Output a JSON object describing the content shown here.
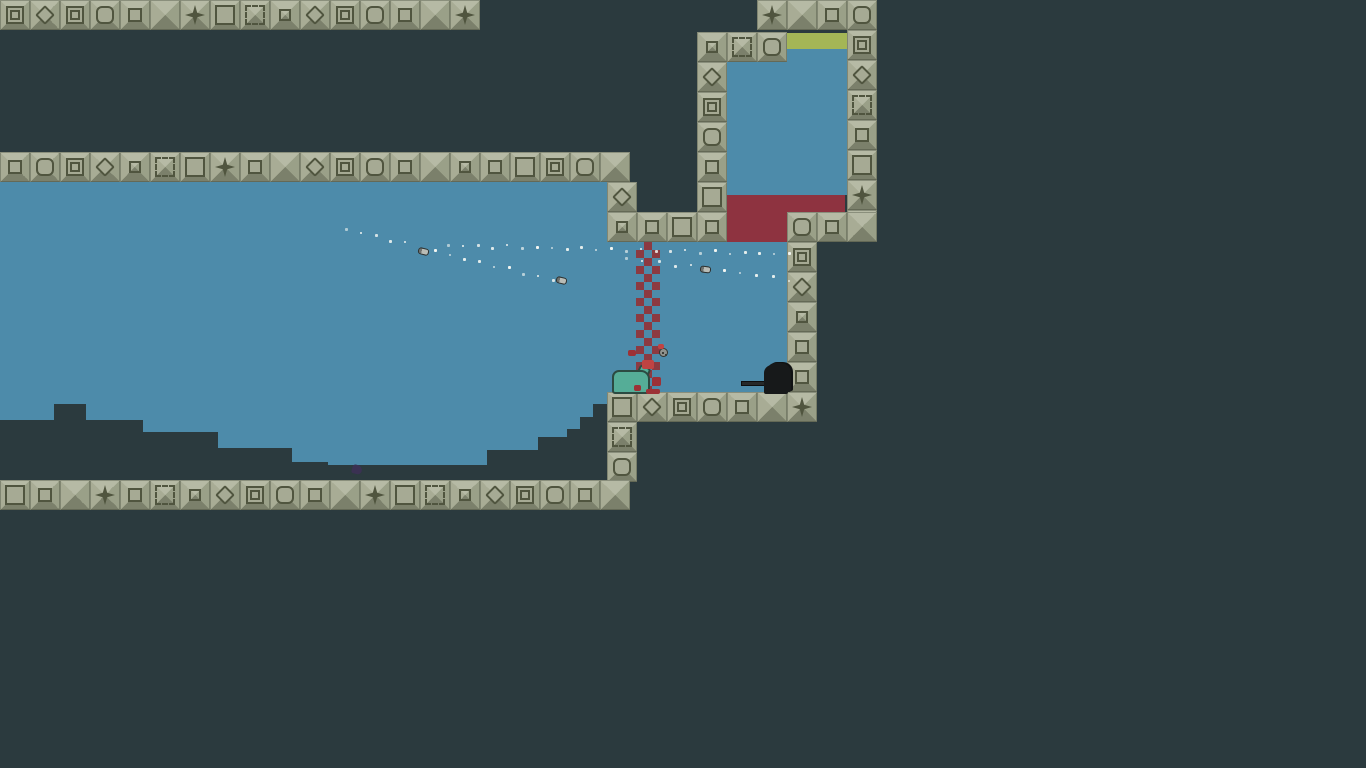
{
  "scene": {
    "width": 1366,
    "height": 768,
    "description": "pixel platformer arena"
  },
  "colors": {
    "background": "#2b3a3e",
    "water": "#4d8baa",
    "red_zone": "#8e3340",
    "green_strip": "#a4b656",
    "checker_red": "#8c3a41",
    "tile_top": "#b6baa5",
    "tile_left": "#a8ac95",
    "tile_right": "#9aa088",
    "tile_bottom": "#7b806b",
    "tile_face": "#a6aa94",
    "tile_line": "#50553f",
    "terrain": "#2b3a3e",
    "trail_dot": "#f3f6f2",
    "blood": "#9c3136",
    "name_text": "#f2f2ef"
  },
  "icons": {
    "heart": "♥"
  },
  "players": [
    {
      "id": "shinoa",
      "name": "Shinoa",
      "x": 255,
      "y": 176
    },
    {
      "id": "broso56",
      "name": "Broso56",
      "x": 612,
      "y": 342
    }
  ],
  "regions": [
    {
      "name": "main-room-water",
      "x": 0,
      "y": 182,
      "w": 610,
      "h": 298,
      "color": "water"
    },
    {
      "name": "passage-water",
      "x": 607,
      "y": 242,
      "w": 180,
      "h": 150,
      "color": "water"
    },
    {
      "name": "upper-room-water",
      "x": 727,
      "y": 48,
      "w": 120,
      "h": 147,
      "color": "water"
    },
    {
      "name": "upper-room-green-strip",
      "x": 787,
      "y": 33,
      "w": 60,
      "h": 16,
      "color": "green_strip"
    },
    {
      "name": "red-zone",
      "x": 727,
      "y": 195,
      "w": 118,
      "h": 47,
      "color": "red_zone"
    }
  ],
  "terrain_steps": [
    {
      "x": 0,
      "y": 420,
      "w": 54
    },
    {
      "x": 54,
      "y": 404,
      "w": 32
    },
    {
      "x": 86,
      "y": 420,
      "w": 57
    },
    {
      "x": 143,
      "y": 432,
      "w": 75
    },
    {
      "x": 218,
      "y": 448,
      "w": 74
    },
    {
      "x": 292,
      "y": 462,
      "w": 36
    },
    {
      "x": 328,
      "y": 465,
      "w": 159
    },
    {
      "x": 487,
      "y": 450,
      "w": 51
    },
    {
      "x": 538,
      "y": 437,
      "w": 29
    },
    {
      "x": 567,
      "y": 429,
      "w": 13
    },
    {
      "x": 580,
      "y": 417,
      "w": 13
    },
    {
      "x": 593,
      "y": 404,
      "w": 14
    }
  ],
  "tile_strips": [
    {
      "name": "ceiling-row",
      "x": 0,
      "y": 0,
      "dir": "h",
      "motifs": [
        "inset",
        "diamond",
        "inset",
        "rounded",
        "square",
        "pyramid",
        "star",
        "osquare",
        "blarge",
        "bsmall",
        "diamond",
        "inset",
        "rounded",
        "square",
        "pyramid",
        "star"
      ]
    },
    {
      "name": "top-right-row",
      "x": 757,
      "y": 0,
      "dir": "h",
      "motifs": [
        "star",
        "pyramid",
        "square",
        "rounded"
      ]
    },
    {
      "name": "upper-room-top-row",
      "x": 727,
      "y": 32,
      "dir": "h",
      "motifs": [
        "blarge",
        "rounded"
      ]
    },
    {
      "name": "upper-room-left-wall",
      "x": 697,
      "y": 32,
      "dir": "v",
      "motifs": [
        "bsmall",
        "diamond",
        "inset",
        "rounded",
        "square",
        "osquare"
      ]
    },
    {
      "name": "upper-room-right-wall",
      "x": 847,
      "y": 30,
      "dir": "v",
      "motifs": [
        "inset",
        "diamond",
        "blarge",
        "square",
        "osquare",
        "star",
        "pyramid"
      ]
    },
    {
      "name": "mid-row",
      "x": 0,
      "y": 152,
      "dir": "h",
      "motifs": [
        "square",
        "rounded",
        "inset",
        "diamond",
        "bsmall",
        "blarge",
        "osquare",
        "star",
        "square",
        "pyramid",
        "diamond",
        "inset",
        "rounded",
        "square",
        "pyramid",
        "bsmall",
        "square",
        "osquare",
        "inset",
        "rounded",
        "pyramid"
      ]
    },
    {
      "name": "main-right-col",
      "x": 607,
      "y": 182,
      "dir": "v",
      "motifs": [
        "diamond"
      ]
    },
    {
      "name": "passage-top-row",
      "x": 607,
      "y": 212,
      "dir": "h",
      "motifs": [
        "bsmall",
        "square",
        "osquare",
        "square"
      ]
    },
    {
      "name": "red-floor-row",
      "x": 787,
      "y": 212,
      "dir": "h",
      "motifs": [
        "rounded",
        "square",
        "pyramid"
      ]
    },
    {
      "name": "subroom-right-wall",
      "x": 787,
      "y": 242,
      "dir": "v",
      "motifs": [
        "inset",
        "diamond",
        "bsmall",
        "square",
        "square",
        "pyramid"
      ]
    },
    {
      "name": "subroom-floor-row",
      "x": 607,
      "y": 392,
      "dir": "h",
      "motifs": [
        "osquare",
        "diamond",
        "inset",
        "rounded",
        "square",
        "pyramid",
        "star"
      ]
    },
    {
      "name": "lower-col",
      "x": 607,
      "y": 422,
      "dir": "v",
      "motifs": [
        "blarge",
        "rounded"
      ]
    },
    {
      "name": "bottom-row",
      "x": 0,
      "y": 480,
      "dir": "h",
      "motifs": [
        "osquare",
        "square",
        "pyramid",
        "star",
        "square",
        "blarge",
        "bsmall",
        "diamond",
        "inset",
        "rounded",
        "square",
        "pyramid",
        "star",
        "osquare",
        "blarge",
        "bsmall",
        "diamond",
        "inset",
        "rounded",
        "square",
        "pyramid"
      ]
    }
  ],
  "checker": {
    "name": "checker-curtain",
    "x": 636,
    "y": 242,
    "w": 24,
    "h": 150,
    "cell": 8
  },
  "trails": [
    {
      "name": "steep-trail",
      "x1": 345,
      "y1": 228,
      "x2": 552,
      "y2": 279,
      "dots": 15
    },
    {
      "name": "shallow-trail",
      "x1": 447,
      "y1": 244,
      "x2": 788,
      "y2": 253,
      "dots": 24
    },
    {
      "name": "low-trail",
      "x1": 625,
      "y1": 257,
      "x2": 788,
      "y2": 278,
      "dots": 11
    }
  ],
  "bullets": [
    {
      "x": 418,
      "y": 248,
      "rot": 14
    },
    {
      "x": 556,
      "y": 277,
      "rot": 14
    },
    {
      "x": 700,
      "y": 266,
      "rot": 7
    }
  ],
  "props": [
    {
      "type": "grenade",
      "x": 659,
      "y": 348
    },
    {
      "type": "corpse",
      "x": 612,
      "y": 366
    },
    {
      "type": "crow",
      "x": 755,
      "y": 360
    },
    {
      "type": "splat",
      "x": 352,
      "y": 465
    },
    {
      "type": "blood",
      "x": 628,
      "y": 350,
      "w": 8,
      "h": 6
    },
    {
      "type": "blood",
      "x": 642,
      "y": 360,
      "w": 12,
      "h": 9,
      "bright": true
    },
    {
      "type": "blood",
      "x": 652,
      "y": 377,
      "w": 9,
      "h": 9
    },
    {
      "type": "blood",
      "x": 634,
      "y": 385,
      "w": 7,
      "h": 6
    },
    {
      "type": "blood",
      "x": 658,
      "y": 344,
      "w": 6,
      "h": 5,
      "bright": true
    },
    {
      "type": "blood",
      "x": 646,
      "y": 389,
      "w": 14,
      "h": 5
    }
  ]
}
